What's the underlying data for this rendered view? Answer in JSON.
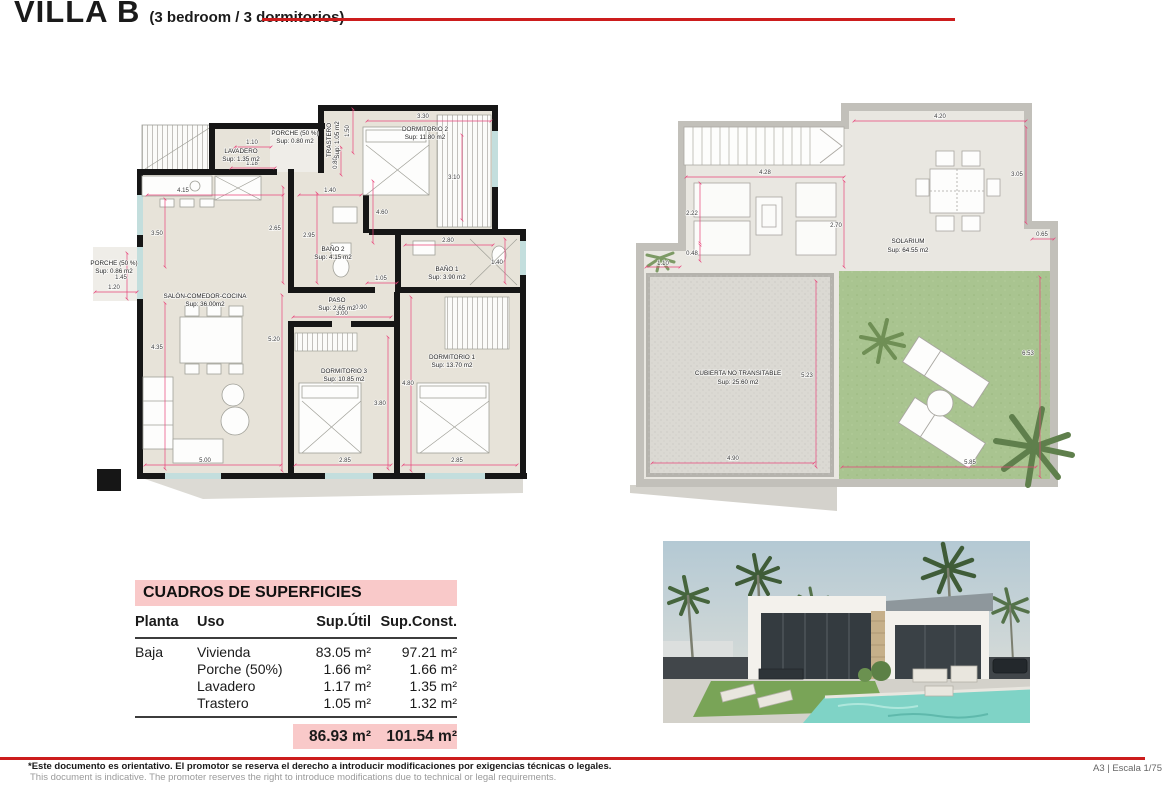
{
  "header": {
    "title": "VILLA B",
    "subtitle": "(3 bedroom / 3 dormitorios)"
  },
  "colors": {
    "accent_red": "#cc1d1d",
    "dimension_pink": "#e8447a",
    "table_pink": "#f9c9c9",
    "floor_beige": "#e7e3d9",
    "grass_green": "#a9c490"
  },
  "ground_floor": {
    "rooms": {
      "porche_top": {
        "name": "PORCHE (50 %)",
        "sup": "Sup: 0.80 m2"
      },
      "lavadero": {
        "name": "LAVADERO",
        "sup": "Sup: 1.35 m2"
      },
      "trastero": {
        "name": "TRASTERO",
        "sup": "Sup: 1.05 m2"
      },
      "dormitorio2": {
        "name": "DORMITORIO 2",
        "sup": "Sup: 11.80 m2"
      },
      "porche_left": {
        "name": "PORCHE (50 %)",
        "sup": "Sup: 0.86 m2"
      },
      "salon": {
        "name": "SALÓN-COMEDOR-COCINA",
        "sup": "Sup: 36.00m2"
      },
      "bano2": {
        "name": "BAÑO 2",
        "sup": "Sup: 4.15 m2"
      },
      "bano1": {
        "name": "BAÑO 1",
        "sup": "Sup: 3.90 m2"
      },
      "paso": {
        "name": "PASO",
        "sup": "Sup: 2.65 m2"
      },
      "dormitorio3": {
        "name": "DORMITORIO 3",
        "sup": "Sup: 10.85 m2"
      },
      "dormitorio1": {
        "name": "DORMITORIO 1",
        "sup": "Sup: 13.70 m2"
      }
    },
    "dims": {
      "lav_w": "1.10",
      "lav_w2": "1.18",
      "tras_h": "1.50",
      "tras_w": "0.80",
      "dorm2_w": "3.30",
      "dorm2_h": "3.10",
      "dorm2_h2": "4.60",
      "salon_top": "4.15",
      "hall_w": "1.40",
      "salon_left": "3.50",
      "hall_h": "2.65",
      "bano2_h": "2.95",
      "bano1_w": "2.80",
      "bano1_h": "1.40",
      "pasillo": "1.05",
      "porche_left_h": "1.45",
      "porche_left_w": "1.20",
      "paso_w": "0.90",
      "paso_l": "3.00",
      "salon_right": "5.20",
      "salon_h": "4.35",
      "dorm3_h": "3.80",
      "dorm1_h": "4.80",
      "salon_w": "5.00",
      "dorm3_w": "2.85",
      "dorm1_w": "2.85"
    }
  },
  "roof": {
    "rooms": {
      "solarium": {
        "name": "SOLARIUM",
        "sup": "Sup: 64.55 m2"
      },
      "cubierta": {
        "name": "CUBIERTA NO TRANSITABLE",
        "sup": "Sup: 25.60 m2"
      }
    },
    "dims": {
      "top_w": "4.20",
      "top_h": "3.05",
      "stairs_w": "4.28",
      "win_h": "2.22",
      "win_off": "0.48",
      "ledge_w": "1.10",
      "mid_h": "2.70",
      "step_w": "0.65",
      "cub_h": "5.23",
      "cub_w": "4.90",
      "grass_h": "6.53",
      "grass_w": "5.85"
    }
  },
  "surfaces": {
    "title": "CUADROS DE SUPERFICIES",
    "headers": [
      "Planta",
      "Uso",
      "Sup.Útil",
      "Sup.Const."
    ],
    "rows": [
      {
        "planta": "Baja",
        "uso": "Vivienda",
        "util": "83.05 m²",
        "const": "97.21 m²"
      },
      {
        "planta": "",
        "uso": "Porche (50%)",
        "util": "1.66 m²",
        "const": "1.66 m²"
      },
      {
        "planta": "",
        "uso": "Lavadero",
        "util": "1.17 m²",
        "const": "1.35 m²"
      },
      {
        "planta": "",
        "uso": "Trastero",
        "util": "1.05 m²",
        "const": "1.32 m²"
      }
    ],
    "total_util": "86.93 m²",
    "total_const": "101.54 m²"
  },
  "footer": {
    "line_es": "*Este documento es orientativo. El promotor se reserva el derecho a introducir modificaciones por exigencias técnicas o legales.",
    "line_en": "This document is indicative. The promoter reserves the right to introduce modifications due to technical or legal requirements.",
    "scale": "A3 | Escala 1/75"
  }
}
